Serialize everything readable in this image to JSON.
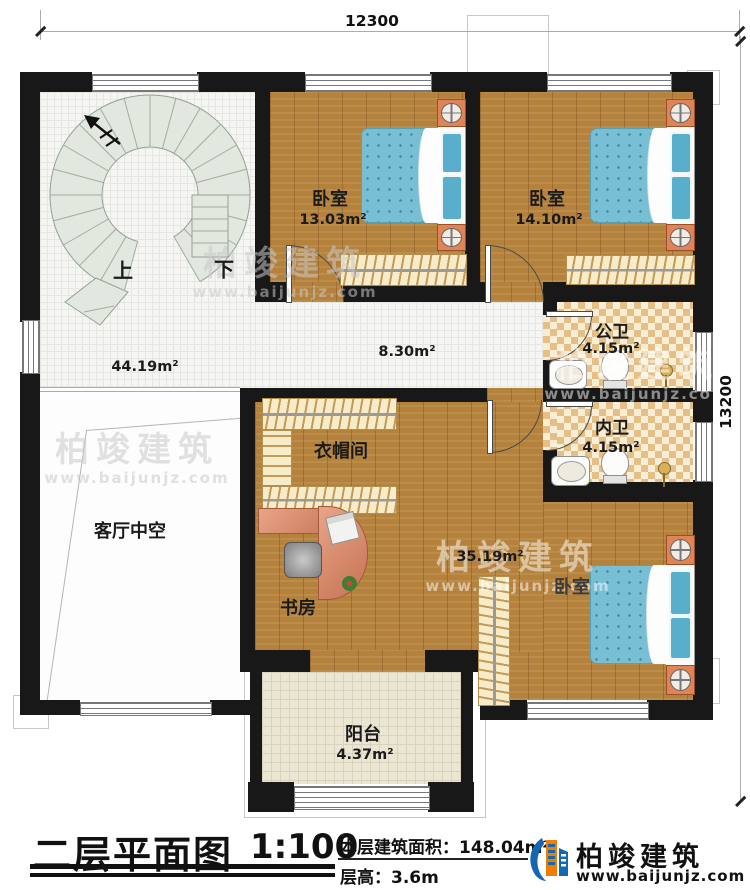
{
  "dimensions": {
    "top": "12300",
    "right": "13200"
  },
  "stairs": {
    "up": "上",
    "down": "下"
  },
  "rooms": {
    "bedroom1": {
      "name": "卧室",
      "area": "13.03m²"
    },
    "bedroom2": {
      "name": "卧室",
      "area": "14.10m²"
    },
    "public_bath": {
      "name": "公卫",
      "area": "4.15m²"
    },
    "inner_bath": {
      "name": "内卫",
      "area": "4.15m²"
    },
    "master_bedroom": {
      "name": "卧室",
      "area": "35.19m²"
    },
    "cloakroom": {
      "name": "衣帽间"
    },
    "study": {
      "name": "书房"
    },
    "living_void": {
      "name": "客厅中空"
    },
    "balcony": {
      "name": "阳台",
      "area": "4.37m²"
    },
    "hall": {
      "area": "44.19m²"
    },
    "corridor": {
      "area": "8.30m²"
    }
  },
  "titleblock": {
    "title": "二层平面图",
    "scale": "1:100",
    "area_label": "本层建筑面积：",
    "area_value": "148.04m²",
    "floor_height_label": "层高：",
    "floor_height_value": "3.6m"
  },
  "brand": {
    "name": "柏竣建筑",
    "website": "www.baijunjz.com"
  },
  "watermark": {
    "name": "柏竣建筑",
    "website": "www.baijunjz.com"
  },
  "colors": {
    "wall": "#181818",
    "wood": "#b5823e",
    "tile": "#f5f5f3",
    "bath_tile": "#e5bf85",
    "bed": "#79bfd4",
    "nightstand": "#e08356",
    "brand_blue": "#1667b2",
    "brand_orange": "#f07d00"
  }
}
